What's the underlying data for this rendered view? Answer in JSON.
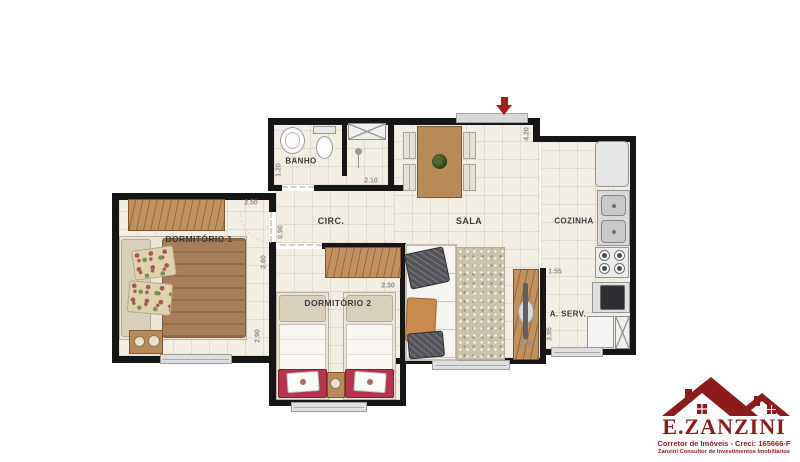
{
  "plan": {
    "rooms": [
      {
        "id": "banho",
        "label": "BANHO"
      },
      {
        "id": "circ",
        "label": "CIRC."
      },
      {
        "id": "sala",
        "label": "SALA"
      },
      {
        "id": "cozinha",
        "label": "COZINHA"
      },
      {
        "id": "dormitorio1",
        "label": "DORMITÓRIO 1"
      },
      {
        "id": "dormitorio2",
        "label": "DORMITÓRIO 2"
      },
      {
        "id": "aserv",
        "label": "A. SERV."
      }
    ],
    "measurements": [
      {
        "value": "1.20"
      },
      {
        "value": "2.50"
      },
      {
        "value": "2.10"
      },
      {
        "value": "4.20"
      },
      {
        "value": "0.90"
      },
      {
        "value": "2.60"
      },
      {
        "value": "2.30"
      },
      {
        "value": "2.90"
      },
      {
        "value": "1.55"
      },
      {
        "value": "3.95"
      },
      {
        "value": "2.40"
      }
    ]
  },
  "logo": {
    "name": "E.ZANZINI",
    "tagline": "Corretor de Imóveis - Creci: 165666-F",
    "subline": "Zanzini Consultor de Investimentos Imobiliários"
  },
  "colors": {
    "wall": "#161616",
    "floor": "#f2eee4",
    "wood": "#c0905e",
    "accent_red": "#8d1b1b",
    "bed_red": "#b5344e"
  }
}
